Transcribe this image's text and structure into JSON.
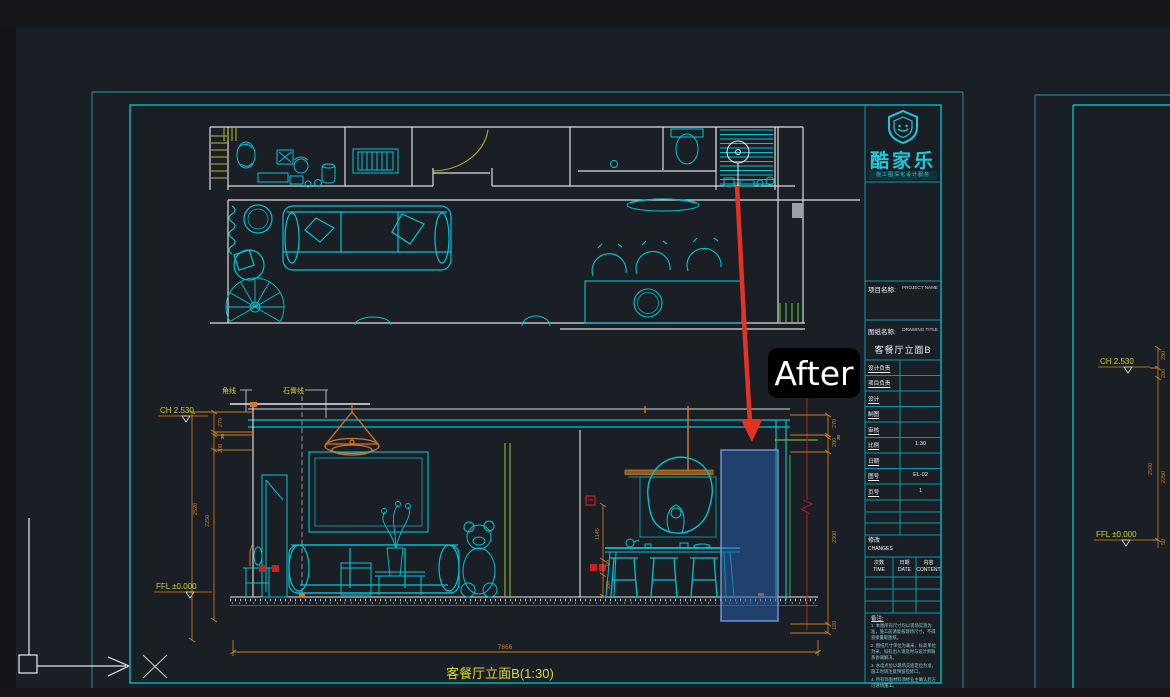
{
  "annotation": {
    "after_label": "After"
  },
  "title_block": {
    "brand_name": "酷家乐",
    "brand_tagline": "施工图深化设计服务",
    "project_label": "项目名称:",
    "project_value": "PROJECT NAME",
    "sheet_label": "图纸名称:",
    "sheet_value": "DRAWING TITLE",
    "drawing_name": "客餐厅立面B",
    "rows": [
      {
        "label": "设计负责",
        "value": ""
      },
      {
        "label": "项目负责",
        "value": ""
      },
      {
        "label": "设计",
        "value": ""
      },
      {
        "label": "制图",
        "value": ""
      },
      {
        "label": "审核",
        "value": ""
      },
      {
        "label": "比例",
        "value": "1:30"
      },
      {
        "label": "日期",
        "value": ""
      },
      {
        "label": "图号",
        "value": "EL-02"
      },
      {
        "label": "页号",
        "value": "1"
      }
    ],
    "changes_label": "修改",
    "changes_label_en": "CHANGES",
    "change_cols": [
      {
        "zh": "次数",
        "en": "TIME"
      },
      {
        "zh": "日期",
        "en": "DATE"
      },
      {
        "zh": "内容",
        "en": "CONTENT"
      }
    ],
    "notes_title": "备注:",
    "notes": [
      "1. 本图所有尺寸均以现场实测为准，施工前请复核现场尺寸，不得直接量取图纸。",
      "2. 图纸尺寸单位为毫米，标高单位为米。如有出入请及时与设计师联系协调解决。",
      "3. 水电点位以现场交底定位为准，施工时请注意预留检修口。",
      "4. 所有饰面材料须经业主确认后方可进场施工。",
      "5. 未尽事宜请与设计师协商解决，图纸未经许可不得转让。"
    ]
  },
  "elevation": {
    "title": "客餐厅立面B(1:30)",
    "ch_label": "CH 2.530",
    "ffl_label": "FFL ±0.000",
    "corner_label": "角线",
    "plaster_label": "石膏线",
    "dims": {
      "left_top": [
        "270",
        "30",
        "200"
      ],
      "left_totals": [
        "2520",
        "2250"
      ],
      "right": [
        "270",
        "30",
        "200",
        "2300",
        "120"
      ],
      "bottom_width": "7866",
      "socket_heights": [
        "1145",
        "90",
        "350"
      ]
    }
  },
  "side_sheet": {
    "ch_label": "CH 2.530",
    "ffl_label": "FFL ±0.000",
    "dims": [
      "230",
      "200",
      "2500",
      "2250",
      "50"
    ]
  }
}
